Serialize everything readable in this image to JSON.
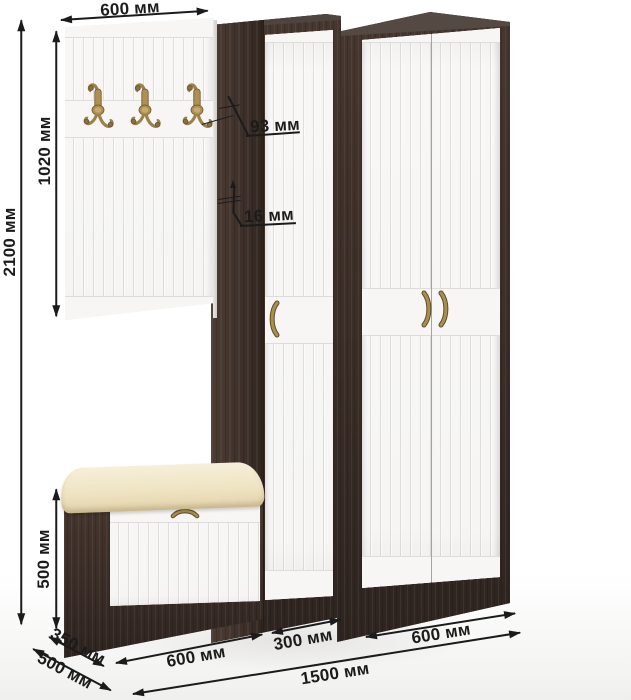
{
  "diagram": {
    "type": "furniture-dimension-diagram",
    "subject": "hallway set: coat panel with hooks, two wardrobes, shoe bench",
    "units": "мм",
    "labels": {
      "panel_width": "600 мм",
      "panel_height": "1020 мм",
      "total_height": "2100 мм",
      "hook_offset": "93 мм",
      "panel_thickness": "16 мм",
      "bench_height": "500 мм",
      "bench_depth": "350 мм",
      "total_depth": "500 мм",
      "bench_width": "600 мм",
      "cabinet_width": "300 мм",
      "wardrobe_width": "600 мм",
      "total_width": "1500 мм"
    },
    "colors": {
      "wenge_brown": "#3a2d27",
      "door_white": "#f6f5f3",
      "cushion_cream": "#eee3c1",
      "brass": "#8a7140",
      "dimension_ink": "#1b1b1b",
      "background": "#ffffff"
    },
    "icons": [
      "coat-hook-icon",
      "wardrobe-handle-icon",
      "door-handle-icon",
      "bench-handle-icon"
    ]
  }
}
